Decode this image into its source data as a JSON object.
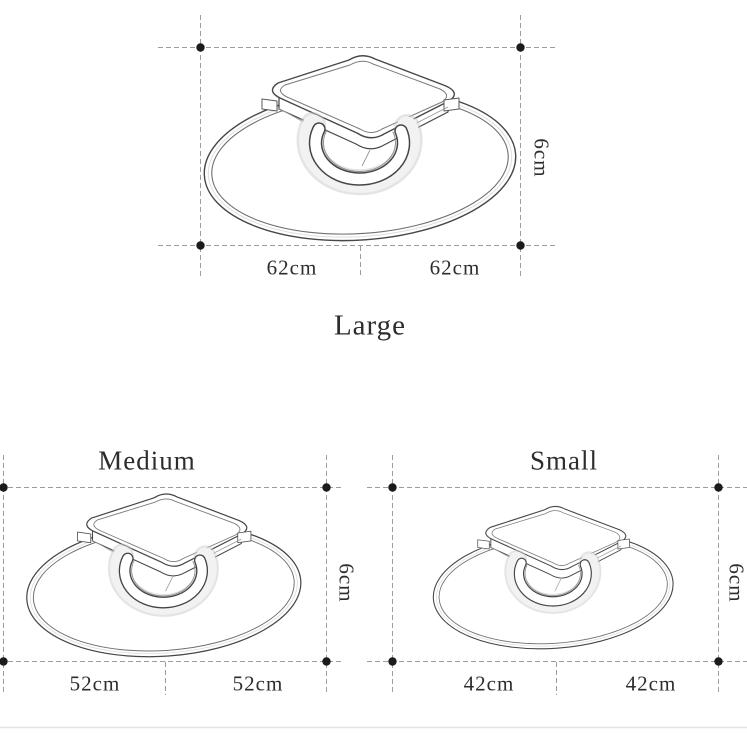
{
  "page": {
    "background": "#ffffff",
    "bottom_divider_color": "#e4e4e4"
  },
  "drawing_style": {
    "dash_color": "#9c9c9c",
    "marker_color": "#1b1b1b",
    "outline_color": "#474747",
    "text_color": "#2d2d2d"
  },
  "sections": [
    {
      "size_name": "Large",
      "width_left": "62cm",
      "width_right": "62cm",
      "height": "6cm"
    },
    {
      "size_name": "Medium",
      "width_left": "52cm",
      "width_right": "52cm",
      "height": "6cm"
    },
    {
      "size_name": "Small",
      "width_left": "42cm",
      "width_right": "42cm",
      "height": "6cm"
    }
  ]
}
